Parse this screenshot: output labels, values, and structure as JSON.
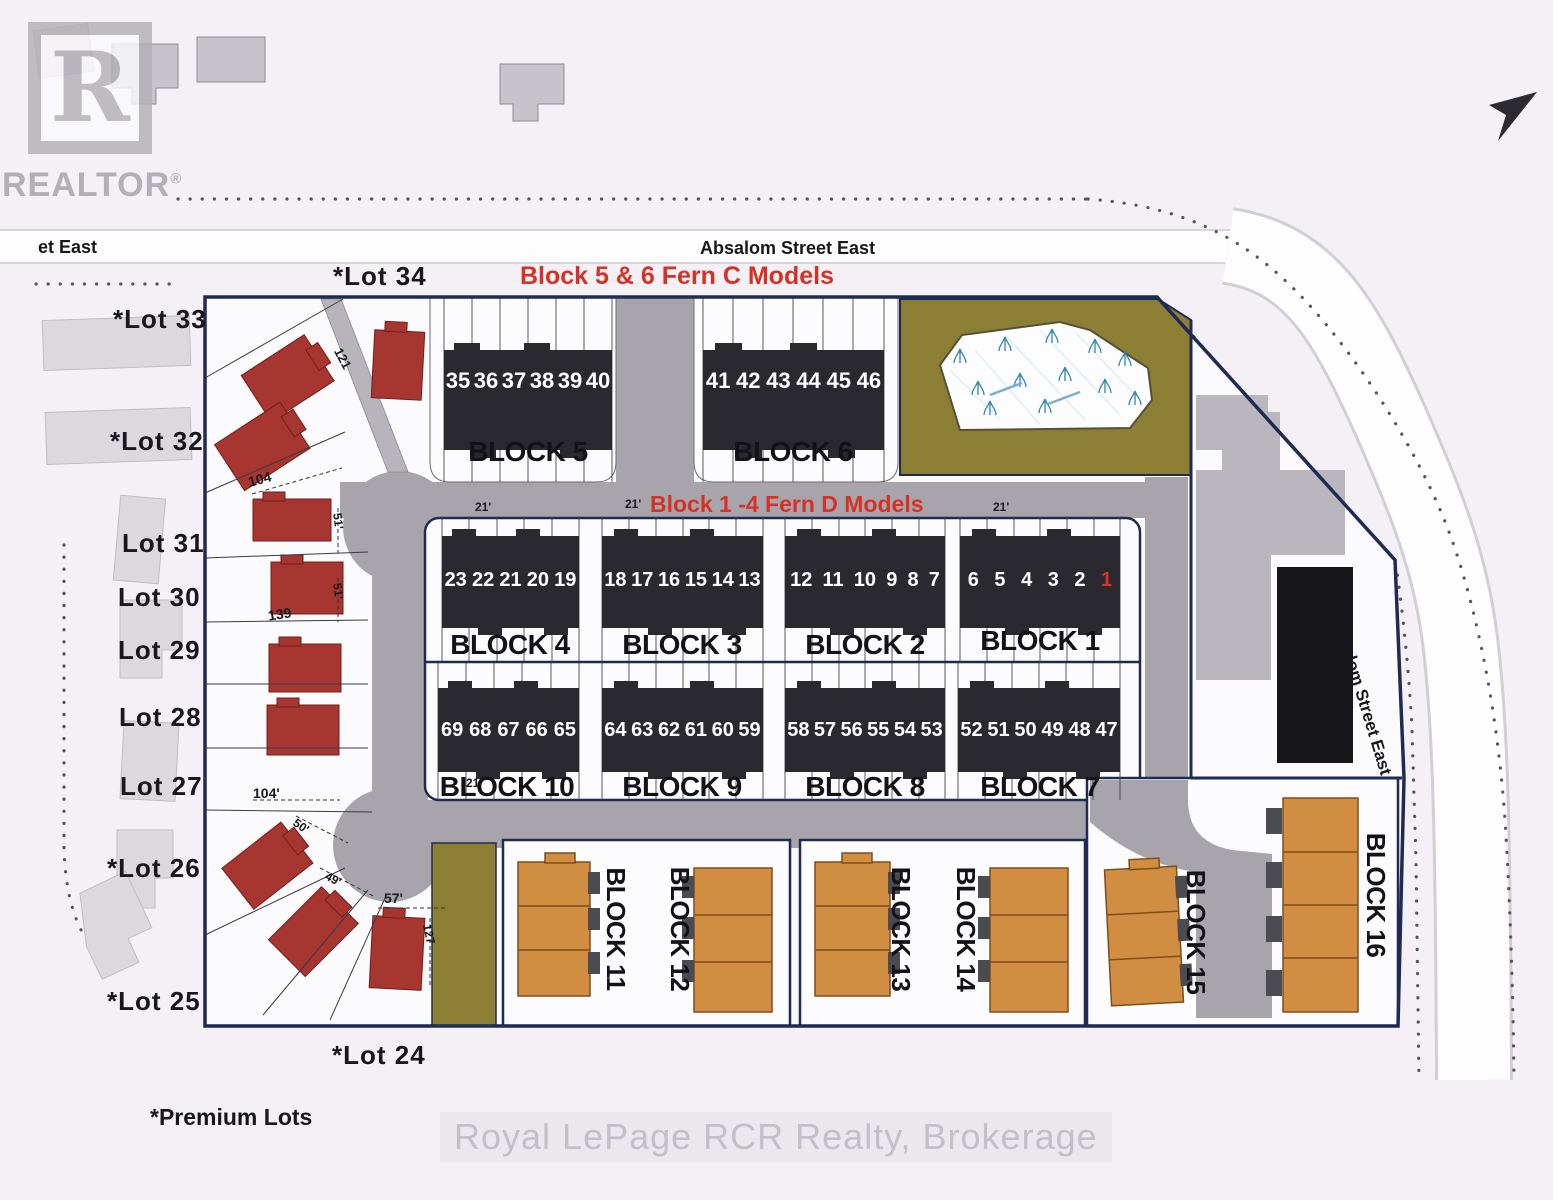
{
  "branding": {
    "logo_letter": "R",
    "logo_text": "REALTOR",
    "registered": "®"
  },
  "streets": {
    "top": "Absalom Street East",
    "left_partial": "et East",
    "right": "Absalom Street East"
  },
  "annotations": {
    "fern_c": "Block 5 & 6 Fern C Models",
    "fern_d": "Block 1 -4 Fern D Models",
    "premium_note": "*Premium Lots"
  },
  "watermark": "Royal LePage RCR Realty, Brokerage",
  "lots": {
    "lot34": "*Lot 34",
    "lot33": "*Lot 33",
    "lot32": "*Lot 32",
    "lot31": "Lot 31",
    "lot30": "Lot 30",
    "lot29": "Lot 29",
    "lot28": "Lot 28",
    "lot27": "Lot 27",
    "lot26": "*Lot 26",
    "lot25": "*Lot 25",
    "lot24": "*Lot 24"
  },
  "blocks": {
    "b5": {
      "label": "BLOCK 5",
      "units": [
        "35",
        "36",
        "37",
        "38",
        "39",
        "40"
      ]
    },
    "b6": {
      "label": "BLOCK 6",
      "units": [
        "41",
        "42",
        "43",
        "44",
        "45",
        "46"
      ]
    },
    "b4": {
      "label": "BLOCK 4",
      "units": [
        "23",
        "22",
        "21",
        "20",
        "19"
      ]
    },
    "b3": {
      "label": "BLOCK 3",
      "units": [
        "18",
        "17",
        "16",
        "15",
        "14",
        "13"
      ]
    },
    "b2": {
      "label": "BLOCK 2",
      "units": [
        "12",
        "11",
        "10",
        "9",
        "8",
        "7"
      ]
    },
    "b1": {
      "label": "BLOCK 1",
      "units_white": [
        "6",
        "5",
        "4",
        "3",
        "2"
      ],
      "unit_red": "1"
    },
    "b10": {
      "label": "BLOCK 10",
      "units": [
        "69",
        "68",
        "67",
        "66",
        "65"
      ]
    },
    "b9": {
      "label": "BLOCK 9",
      "units": [
        "64",
        "63",
        "62",
        "61",
        "60",
        "59"
      ]
    },
    "b8": {
      "label": "BLOCK 8",
      "units": [
        "58",
        "57",
        "56",
        "55",
        "54",
        "53"
      ]
    },
    "b7": {
      "label": "BLOCK 7",
      "units": [
        "52",
        "51",
        "50",
        "49",
        "48",
        "47"
      ]
    },
    "b11": {
      "label": "BLOCK 11"
    },
    "b12": {
      "label": "BLOCK 12"
    },
    "b13": {
      "label": "BLOCK 13"
    },
    "b14": {
      "label": "BLOCK 14"
    },
    "b15": {
      "label": "BLOCK 15"
    },
    "b16": {
      "label": "BLOCK 16"
    }
  },
  "dimensions": {
    "d121": "121",
    "d104a": "104",
    "d51a": "51'",
    "d51b": "51'",
    "d139": "139",
    "d104b": "104'",
    "d50": "50'",
    "d49": "49'",
    "d57": "57'",
    "d127": "127",
    "d21a": "21'",
    "d21b": "21'",
    "d21c": "21'",
    "d21d": "21'"
  },
  "colors": {
    "highlight_red": "#d53227",
    "unit_red": "#e03427",
    "road_gray": "#a8a4ab",
    "olive": "#8c7f33",
    "townhouse_dark": "#29292f",
    "orange_building": "#d18d41",
    "red_house": "#a73631",
    "boundary_navy": "#1d2b55"
  }
}
